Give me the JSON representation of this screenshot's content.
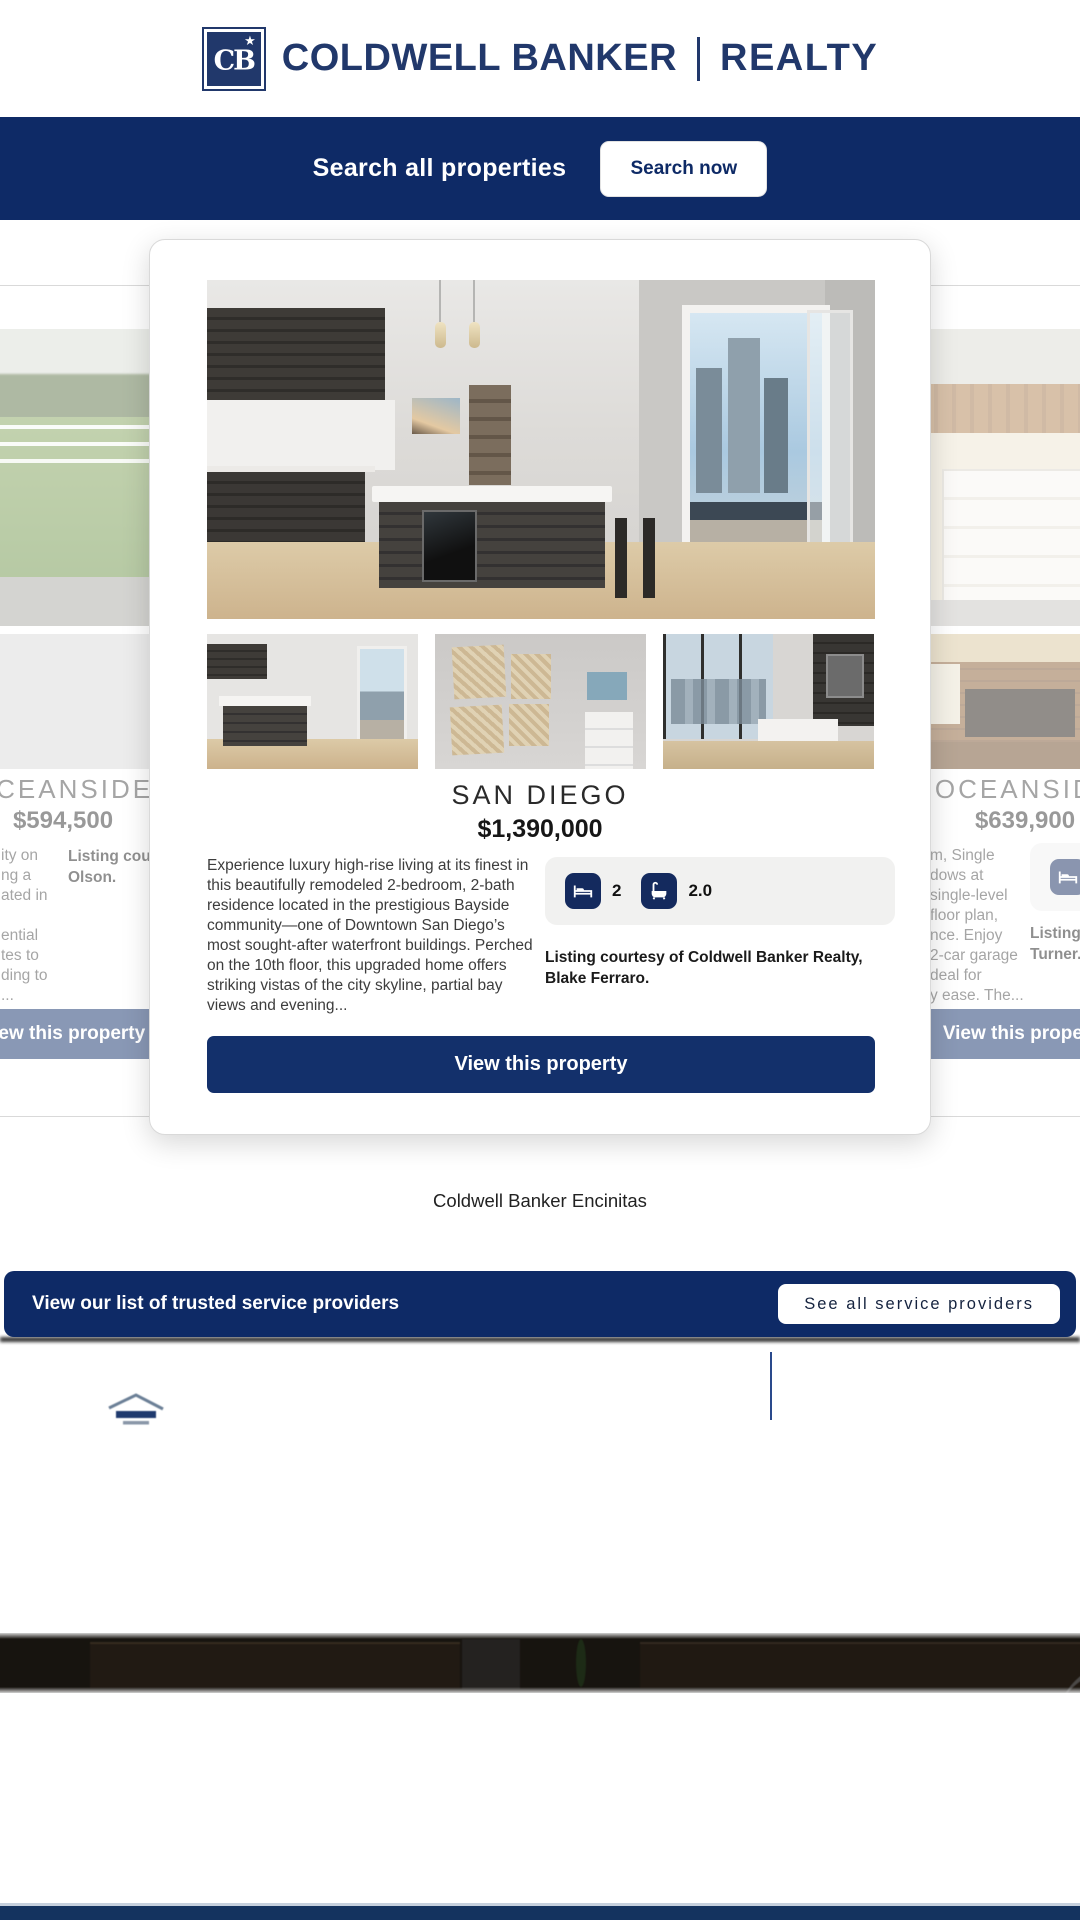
{
  "brand": {
    "monogram": "CB",
    "name": "COLDWELL BANKER",
    "division": "REALTY"
  },
  "search_bar": {
    "label": "Search all properties",
    "button_label": "Search now"
  },
  "carousel": {
    "prev_card": {
      "city": "OCEANSIDE",
      "price": "$594,500",
      "description_fragment": "ity on\nng a\nated in\n \nential\ntes to\nding to\n...",
      "listing_fragment": "Listing courte\nOlson.",
      "cta_label": "View this property"
    },
    "active_card": {
      "city": "SAN DIEGO",
      "price": "$1,390,000",
      "description": "Experience luxury high-rise living at its finest in this beautifully remodeled 2-bedroom, 2-bath residence located in the prestigious Bayside community—one of Downtown San Diego’s most sought-after waterfront buildings. Perched on the 10th floor, this upgraded home offers striking vistas of the city skyline, partial bay views and evening...",
      "beds": "2",
      "baths": "2.0",
      "listing_courtesy": "Listing courtesy of Coldwell Banker Realty, Blake Ferraro.",
      "cta_label": "View this property"
    },
    "next_card": {
      "city": "OCEANSIDE",
      "price": "$639,900",
      "description_fragment": "m, Single\ndows at\nsingle-level\nfloor plan,\nnce. Enjoy\n2-car garage\ndeal for\ny ease. The...",
      "beds": "2",
      "listing_fragment": "Listing c\nTurner.",
      "cta_label": "View this property"
    }
  },
  "office": {
    "name": "Coldwell Banker Encinitas"
  },
  "providers_bar": {
    "label": "View our list of trusted service providers",
    "button_label": "See all service providers"
  },
  "colors": {
    "navy_bar": "#0E2A66",
    "logo_navy": "#21386B",
    "cta_navy": "#13306B",
    "facts_bg": "#f1f1f0"
  }
}
